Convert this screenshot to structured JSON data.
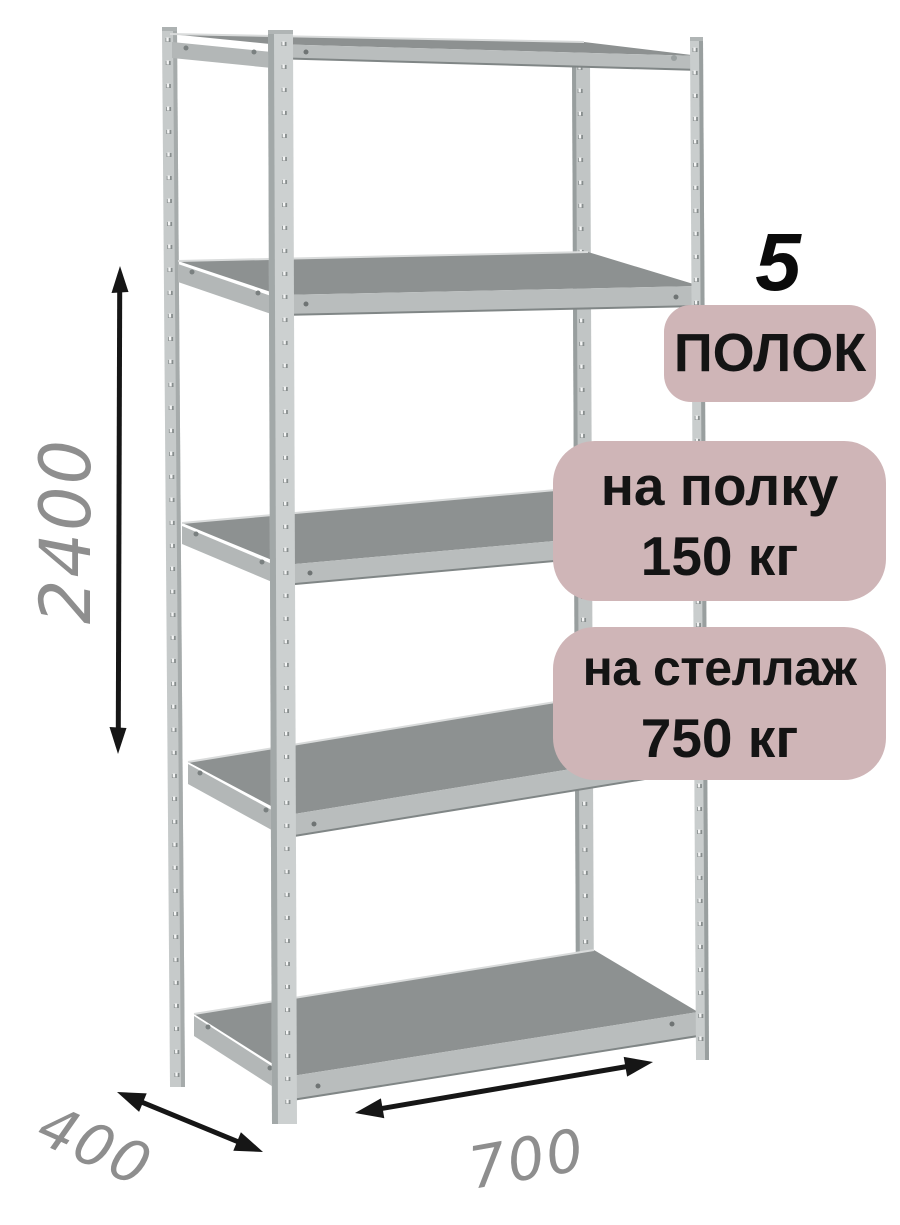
{
  "diagram": {
    "shelf_count": {
      "number": "5",
      "label": "ПОЛОК"
    },
    "per_shelf_load": {
      "line1": "на полку",
      "line2": "150 кг"
    },
    "total_load": {
      "line1": "на стеллаж",
      "line2": "750 кг"
    },
    "dimensions": {
      "height": "2400",
      "depth": "400",
      "width": "700"
    },
    "colors": {
      "background": "#ffffff",
      "badge_background": "#cfb5b7",
      "badge_text": "#141414",
      "count_text": "#0b0b0b",
      "dimension_text": "#8e8e8e",
      "arrow": "#161616",
      "metal_light": "#ccd0d0",
      "metal_mid": "#b3b7b7",
      "shelf_surface": "#8d9191"
    }
  }
}
